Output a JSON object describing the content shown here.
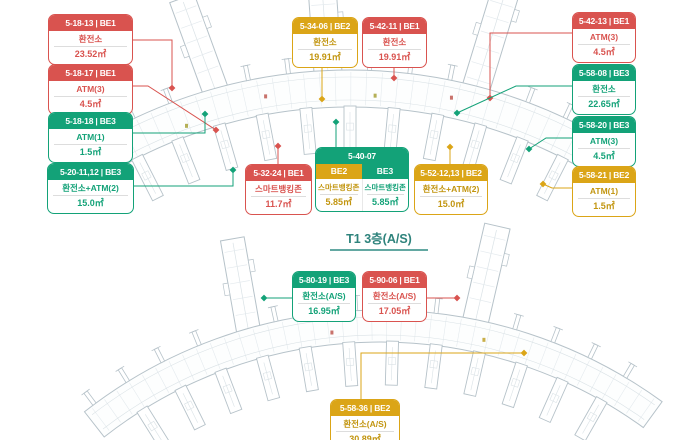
{
  "titles": {
    "bottom_map": "T1 3층(A/S)"
  },
  "colors": {
    "red": "#D9534F",
    "green": "#13A278",
    "yellow": "#DBA517",
    "title_teal": "#2E837C",
    "map_line": "#B6C2C9"
  },
  "labels": [
    {
      "id": "top-partial",
      "map": "top",
      "color": "yellow",
      "code": "",
      "name": "",
      "area": "4.5㎡"
    },
    {
      "id": "5-18-13",
      "map": "top",
      "color": "red",
      "code": "5-18-13 | BE1",
      "name": "환전소",
      "area": "23.52㎡"
    },
    {
      "id": "5-18-17",
      "map": "top",
      "color": "red",
      "code": "5-18-17 | BE1",
      "name": "ATM(3)",
      "area": "4.5㎡"
    },
    {
      "id": "5-18-18",
      "map": "top",
      "color": "green",
      "code": "5-18-18 | BE3",
      "name": "ATM(1)",
      "area": "1.5㎡"
    },
    {
      "id": "5-20-11,12",
      "map": "top",
      "color": "green",
      "code": "5-20-11,12 | BE3",
      "name": "환전소+ATM(2)",
      "area": "15.0㎡"
    },
    {
      "id": "5-34-06",
      "map": "top",
      "color": "yellow",
      "code": "5-34-06 | BE2",
      "name": "환전소",
      "area": "19.91㎡"
    },
    {
      "id": "5-42-11",
      "map": "top",
      "color": "red",
      "code": "5-42-11 | BE1",
      "name": "환전소",
      "area": "19.91㎡"
    },
    {
      "id": "5-42-13",
      "map": "top",
      "color": "red",
      "code": "5-42-13 | BE1",
      "name": "ATM(3)",
      "area": "4.5㎡"
    },
    {
      "id": "5-58-08",
      "map": "top",
      "color": "green",
      "code": "5-58-08 | BE3",
      "name": "환전소",
      "area": "22.65㎡"
    },
    {
      "id": "5-58-20",
      "map": "top",
      "color": "green",
      "code": "5-58-20 | BE3",
      "name": "ATM(3)",
      "area": "4.5㎡"
    },
    {
      "id": "5-58-21",
      "map": "top",
      "color": "yellow",
      "code": "5-58-21 | BE2",
      "name": "ATM(1)",
      "area": "1.5㎡"
    },
    {
      "id": "5-52-12,13",
      "map": "top",
      "color": "yellow",
      "code": "5-52-12,13 | BE2",
      "name": "환전소+ATM(2)",
      "area": "15.0㎡"
    },
    {
      "id": "5-32-24",
      "map": "top",
      "color": "red",
      "code": "5-32-24 | BE1",
      "name": "스마트뱅킹존",
      "area": "11.7㎡"
    },
    {
      "id": "5-80-19",
      "map": "bottom",
      "color": "green",
      "code": "5-80-19 | BE3",
      "name": "환전소(A/S)",
      "area": "16.95㎡"
    },
    {
      "id": "5-90-06",
      "map": "bottom",
      "color": "red",
      "code": "5-90-06 | BE1",
      "name": "환전소(A/S)",
      "area": "17.05㎡"
    },
    {
      "id": "5-58-36",
      "map": "bottom",
      "color": "yellow",
      "code": "5-58-36 | BE2",
      "name": "환전소(A/S)",
      "area": "30.89㎡"
    }
  ],
  "combo_label": {
    "id": "5-40-07",
    "code": "5-40-07",
    "columns": [
      {
        "zone": "BE2",
        "color": "yellow",
        "name": "스마트뱅킹존",
        "area": "5.85㎡"
      },
      {
        "zone": "BE3",
        "color": "green",
        "name": "스마트뱅킹존",
        "area": "5.85㎡"
      }
    ]
  }
}
